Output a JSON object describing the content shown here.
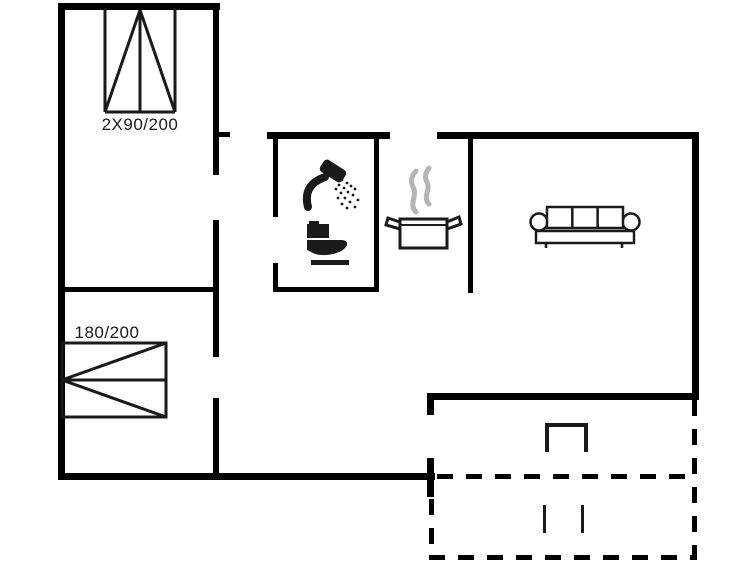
{
  "floorplan": {
    "colors": {
      "background": "#ffffff",
      "walls": "#000000",
      "symbols": "#1a1a1a",
      "steam": "#b5b5b5"
    },
    "labels": {
      "double_door_window": "2X90/200",
      "double_bed": "180/200"
    },
    "icons": [
      "double-door-window-symbol",
      "double-bed-symbol",
      "shower-icon",
      "toilet-icon",
      "cooking-pot-icon",
      "steam-icon",
      "sofa-icon",
      "terrace-steps-symbol",
      "terrace-dashed-outline"
    ]
  }
}
